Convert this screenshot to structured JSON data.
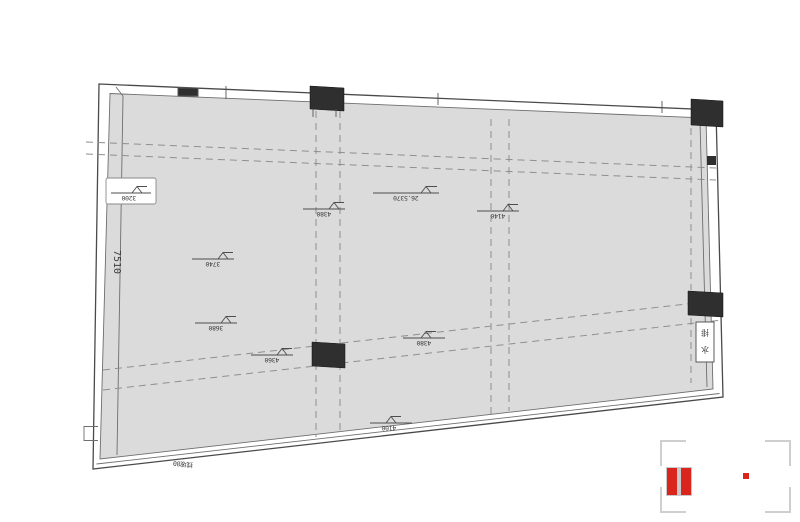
{
  "drawing": {
    "left_dimension": "7510",
    "boxed_marker": {
      "label": "3200"
    },
    "markers": [
      {
        "label": "3740"
      },
      {
        "label": "3680"
      },
      {
        "label": "4380"
      },
      {
        "label": "26.5370"
      },
      {
        "label": "4140"
      },
      {
        "label": "4360"
      },
      {
        "label": "4380"
      },
      {
        "label": "4100"
      }
    ],
    "shaft_label_top": "排",
    "shaft_label_bottom": "水",
    "slope_note": "找坡80",
    "colors": {
      "floor_fill": "#dbdbdb",
      "wall_stroke": "#4a4a4a",
      "column_fill": "#2f2f2f",
      "dashed_stroke": "#8f8f8f"
    }
  },
  "watermark": {
    "accent_color": "#d9251d"
  }
}
